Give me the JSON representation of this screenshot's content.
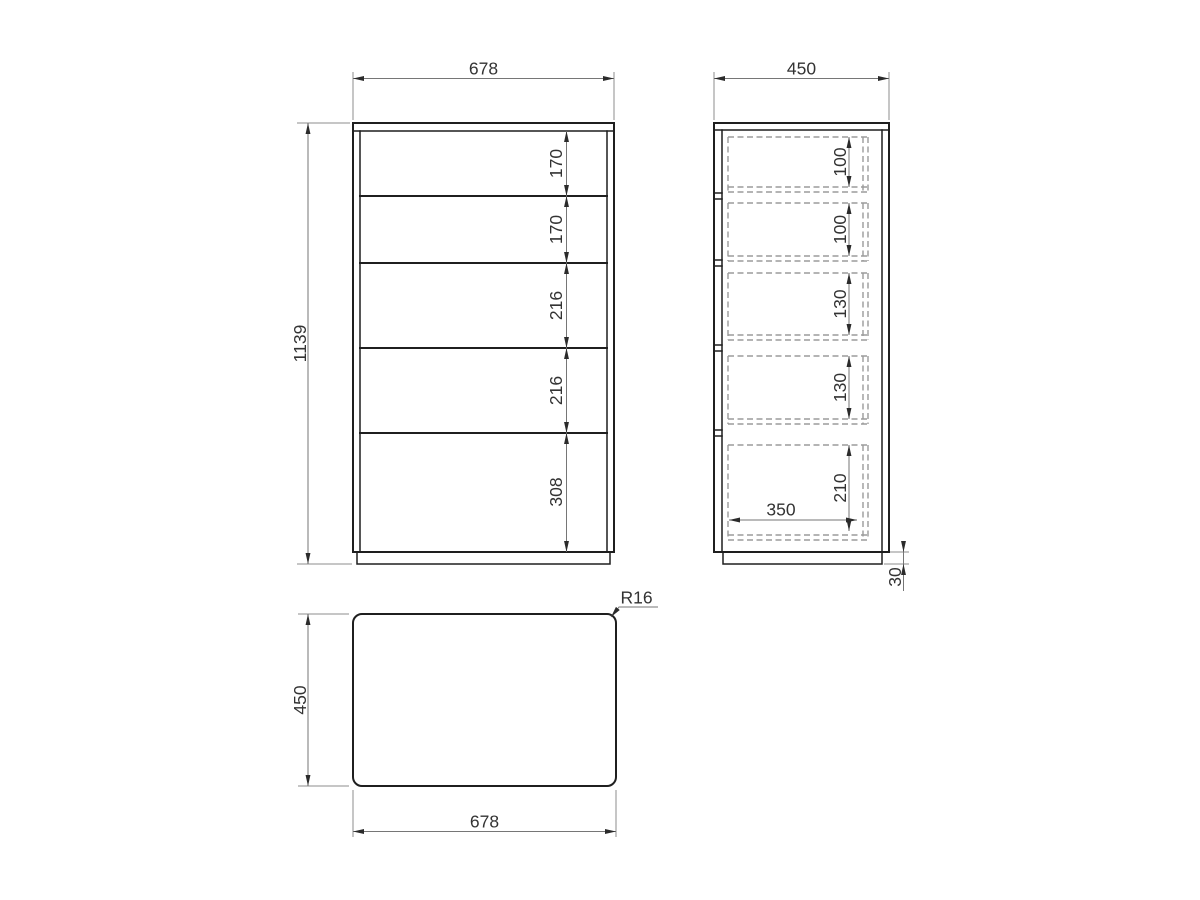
{
  "drawing_type": "furniture-dimension-drawing-chest-of-drawers",
  "front_view": {
    "width": "678",
    "height": "1139",
    "drawer_heights": [
      "170",
      "170",
      "216",
      "216",
      "308"
    ]
  },
  "side_view": {
    "depth": "450",
    "drawer_inner_heights": [
      "100",
      "100",
      "130",
      "130",
      "210"
    ],
    "drawer_inner_depth": "350",
    "base_height": "30"
  },
  "top_view": {
    "depth": "450",
    "width": "678",
    "corner_radius": "R16"
  },
  "colors": {
    "background": "#ffffff",
    "object_line": "#1f1f1f",
    "hidden_line": "#9b9b9b",
    "dimension_line": "#767676",
    "text": "#333333"
  }
}
